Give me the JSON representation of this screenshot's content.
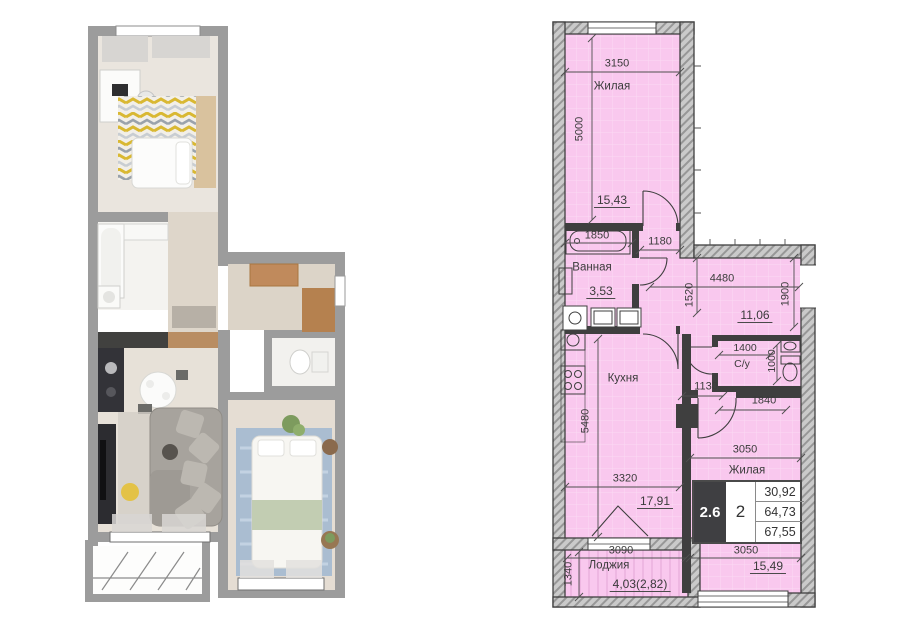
{
  "colors": {
    "room_fill": "#f9c8ee",
    "wall_hatch": "#cacaca",
    "wall_line": "#3f3f3f",
    "render_wall": "#9c9c9c",
    "accent_rug_yellow": "#d9b832",
    "accent_rug_blue": "#aabdd1"
  },
  "plan2d": {
    "rooms": {
      "living_top": {
        "name": "Жилая",
        "area": "15,43"
      },
      "bathroom": {
        "name": "Ванная",
        "area": "3,53"
      },
      "hallway": {
        "area": "11,06"
      },
      "wc": {
        "name": "С/у"
      },
      "kitchen": {
        "name": "Кухня",
        "area": "17,91"
      },
      "living_bottom": {
        "name": "Жилая",
        "area": "15,49"
      },
      "loggia": {
        "name": "Лоджия",
        "area": "4,03(2,82)"
      }
    },
    "dims": {
      "d3150": "3150",
      "d5000": "5000",
      "d1850": "1850",
      "d1180": "1180",
      "d4480": "4480",
      "d1520": "1520",
      "d1900": "1900",
      "d1400": "1400",
      "d1000": "1000",
      "d1130": "1130",
      "d1840": "1840",
      "d5480": "5480",
      "d3320": "3320",
      "d3050a": "3050",
      "d3050b": "3050",
      "d3090": "3090",
      "d1340": "1340"
    },
    "info_table": {
      "plan_code": "2.6",
      "rooms_count": "2",
      "living_area": "30,92",
      "area_excl_loggia": "64,73",
      "area_total": "67,55"
    }
  }
}
